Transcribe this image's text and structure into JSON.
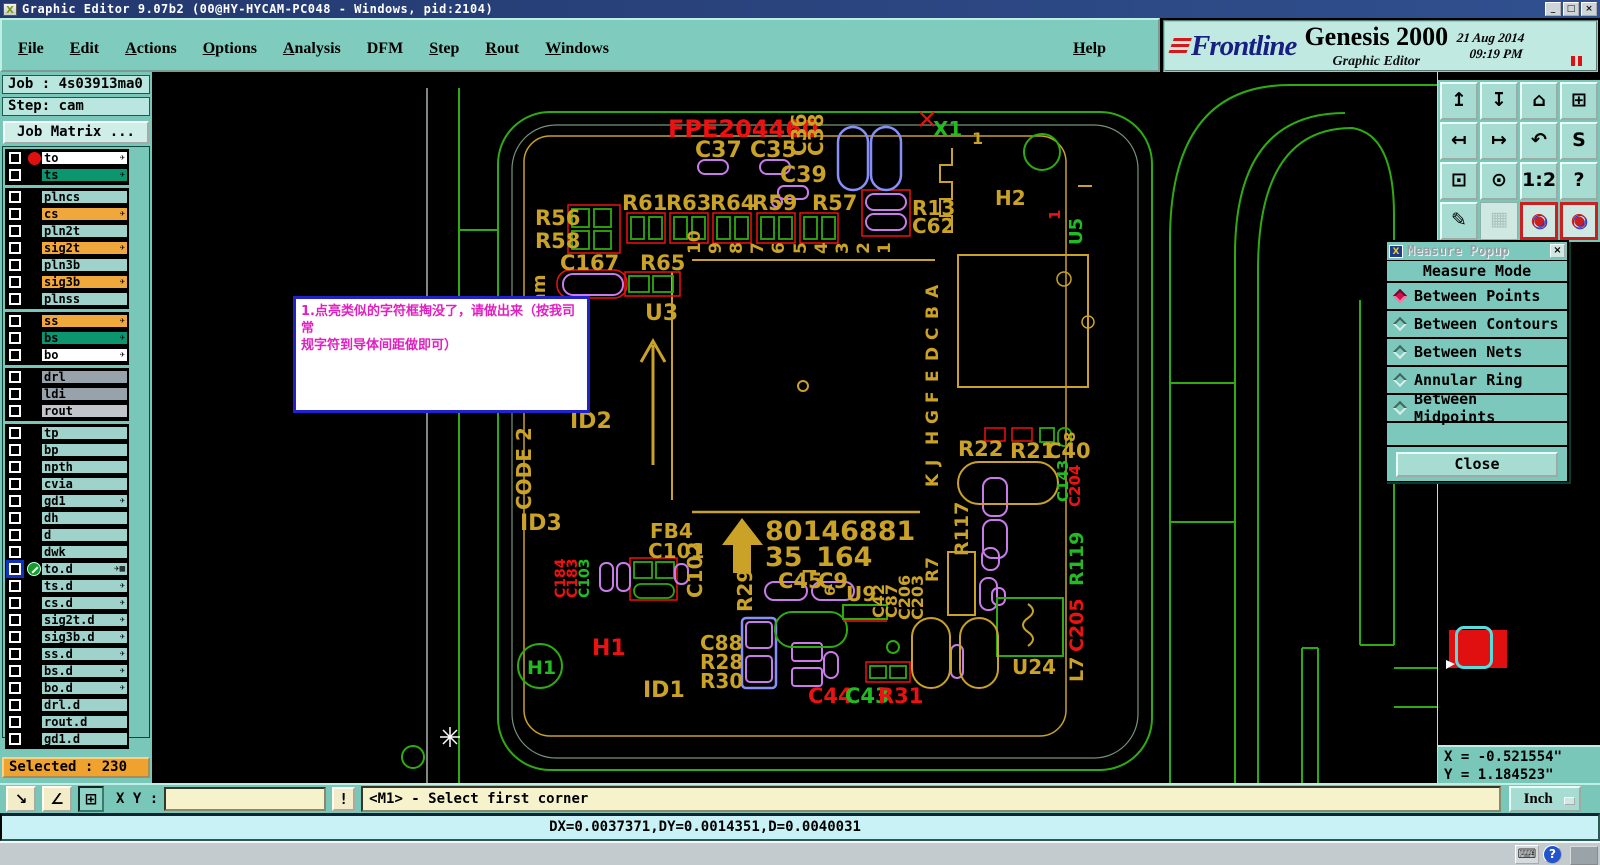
{
  "titlebar": {
    "title": "Graphic Editor 9.07b2 (00@HY-HYCAM-PC048 - Windows, pid:2104)",
    "window_buttons": [
      "_",
      "□",
      "×"
    ]
  },
  "menubar": {
    "items": [
      {
        "label": "File",
        "u": true
      },
      {
        "label": "Edit",
        "u": true
      },
      {
        "label": "Actions",
        "u": true
      },
      {
        "label": "Options",
        "u": true
      },
      {
        "label": "Analysis",
        "u": true
      },
      {
        "label": "DFM",
        "u": false
      },
      {
        "label": "Step",
        "u": true
      },
      {
        "label": "Rout",
        "u": true
      },
      {
        "label": "Windows",
        "u": true
      }
    ],
    "help": {
      "label": "Help",
      "u": true
    }
  },
  "brand": {
    "logo": "Frontline",
    "product": "Genesis 2000",
    "edition": "Graphic Editor",
    "date": "21 Aug 2014",
    "time": "09:19 PM"
  },
  "sidebar": {
    "job": "Job : 4s03913ma0",
    "step": "Step: cam",
    "job_matrix": "Job Matrix ...",
    "selected": "Selected : 230",
    "layer_groups": [
      [
        {
          "name": "to",
          "bg": "white",
          "arrow": true,
          "dot": true
        },
        {
          "name": "ts",
          "bg": "green",
          "arrow": true
        }
      ],
      [
        {
          "name": "plncs",
          "bg": "teal"
        },
        {
          "name": "cs",
          "bg": "orange",
          "arrow": true
        },
        {
          "name": "pln2t",
          "bg": "teal"
        },
        {
          "name": "sig2t",
          "bg": "orange",
          "arrow": true
        },
        {
          "name": "pln3b",
          "bg": "teal"
        },
        {
          "name": "sig3b",
          "bg": "orange",
          "arrow": true
        },
        {
          "name": "plnss",
          "bg": "teal"
        }
      ],
      [
        {
          "name": "ss",
          "bg": "orange",
          "arrow": true
        },
        {
          "name": "bs",
          "bg": "green",
          "arrow": true
        },
        {
          "name": "bo",
          "bg": "white",
          "arrow": true
        }
      ],
      [
        {
          "name": "drl",
          "bg": "gray"
        },
        {
          "name": "ldi",
          "bg": "gray"
        },
        {
          "name": "rout",
          "bg": "lightgray"
        }
      ],
      [
        {
          "name": "tp",
          "bg": "teal"
        },
        {
          "name": "bp",
          "bg": "teal"
        },
        {
          "name": "npth",
          "bg": "teal"
        },
        {
          "name": "cvia",
          "bg": "teal"
        },
        {
          "name": "gd1",
          "bg": "teal",
          "arrow": true
        },
        {
          "name": "dh",
          "bg": "teal"
        },
        {
          "name": "d",
          "bg": "teal"
        },
        {
          "name": "dwk",
          "bg": "teal"
        },
        {
          "name": "to.d",
          "bg": "teal",
          "arrow": true,
          "selected": true,
          "extra": "▦"
        },
        {
          "name": "ts.d",
          "bg": "teal",
          "arrow": true
        },
        {
          "name": "cs.d",
          "bg": "teal",
          "arrow": true
        },
        {
          "name": "sig2t.d",
          "bg": "teal",
          "arrow": true
        },
        {
          "name": "sig3b.d",
          "bg": "teal",
          "arrow": true
        },
        {
          "name": "ss.d",
          "bg": "teal",
          "arrow": true
        },
        {
          "name": "bs.d",
          "bg": "teal",
          "arrow": true
        },
        {
          "name": "bo.d",
          "bg": "teal",
          "arrow": true
        },
        {
          "name": "drl.d",
          "bg": "teal"
        },
        {
          "name": "rout.d",
          "bg": "teal"
        },
        {
          "name": "gd1.d",
          "bg": "teal"
        }
      ]
    ]
  },
  "canvas": {
    "silk": "#c9a227",
    "note": {
      "line1": "1.点亮类似的字符框掏没了，请做出来（按我司常",
      "line2": "规字符到导体间距做即可）"
    },
    "labels": [
      {
        "t": "FPE204460",
        "x": 668,
        "y": 137,
        "s": 24,
        "c": "#ee1111"
      },
      {
        "t": "C37",
        "x": 695,
        "y": 157,
        "s": 22
      },
      {
        "t": "C35",
        "x": 750,
        "y": 157,
        "s": 22
      },
      {
        "t": "C36",
        "x": 806,
        "y": 156,
        "s": 20,
        "r": -90
      },
      {
        "t": "C38",
        "x": 823,
        "y": 156,
        "s": 20,
        "r": -90
      },
      {
        "t": "C39",
        "x": 780,
        "y": 182,
        "s": 22
      },
      {
        "t": "R61",
        "x": 622,
        "y": 210,
        "s": 21
      },
      {
        "t": "R63",
        "x": 666,
        "y": 210,
        "s": 21
      },
      {
        "t": "R64",
        "x": 710,
        "y": 210,
        "s": 21
      },
      {
        "t": "R59",
        "x": 752,
        "y": 210,
        "s": 21
      },
      {
        "t": "R57",
        "x": 812,
        "y": 210,
        "s": 21
      },
      {
        "t": "R13",
        "x": 912,
        "y": 215,
        "s": 20
      },
      {
        "t": "C62",
        "x": 912,
        "y": 233,
        "s": 20
      },
      {
        "t": "X1",
        "x": 933,
        "y": 136,
        "s": 20,
        "c": "#22bb22"
      },
      {
        "t": "1",
        "x": 972,
        "y": 144,
        "s": 16
      },
      {
        "t": "H2",
        "x": 995,
        "y": 205,
        "s": 20
      },
      {
        "t": "1",
        "x": 1060,
        "y": 220,
        "s": 15,
        "c": "#ee1111",
        "r": -90
      },
      {
        "t": "U5",
        "x": 1082,
        "y": 245,
        "s": 18,
        "c": "#22bb22",
        "r": -90
      },
      {
        "t": "R56",
        "x": 535,
        "y": 225,
        "s": 21
      },
      {
        "t": "R58",
        "x": 535,
        "y": 248,
        "s": 21
      },
      {
        "t": "C167",
        "x": 560,
        "y": 270,
        "s": 21
      },
      {
        "t": "R65",
        "x": 640,
        "y": 270,
        "s": 21
      },
      {
        "t": "mm",
        "x": 545,
        "y": 312,
        "s": 18,
        "r": -90
      },
      {
        "t": "U3",
        "x": 645,
        "y": 320,
        "s": 22
      },
      {
        "t": "ID2",
        "x": 570,
        "y": 428,
        "s": 22
      },
      {
        "t": "CODE 2",
        "x": 531,
        "y": 510,
        "s": 20,
        "r": -90
      },
      {
        "t": "ID3",
        "x": 520,
        "y": 530,
        "s": 22
      },
      {
        "t": "FB4",
        "x": 650,
        "y": 538,
        "s": 20
      },
      {
        "t": "C101",
        "x": 648,
        "y": 558,
        "s": 20
      },
      {
        "t": "C102",
        "x": 702,
        "y": 598,
        "s": 20,
        "r": -90
      },
      {
        "t": "C184",
        "x": 565,
        "y": 598,
        "s": 14,
        "c": "#ee1111",
        "r": -90
      },
      {
        "t": "C183",
        "x": 577,
        "y": 598,
        "s": 14,
        "c": "#ee1111",
        "r": -90
      },
      {
        "t": "C103",
        "x": 589,
        "y": 598,
        "s": 14,
        "c": "#22bb22",
        "r": -90
      },
      {
        "t": "80146881",
        "x": 765,
        "y": 540,
        "s": 27
      },
      {
        "t": "35_164",
        "x": 765,
        "y": 566,
        "s": 27
      },
      {
        "t": "R29",
        "x": 752,
        "y": 612,
        "s": 20,
        "r": -90
      },
      {
        "t": "C45",
        "x": 778,
        "y": 588,
        "s": 21
      },
      {
        "t": "C9",
        "x": 818,
        "y": 588,
        "s": 21
      },
      {
        "t": "U9",
        "x": 846,
        "y": 601,
        "s": 20
      },
      {
        "t": "6",
        "x": 835,
        "y": 596,
        "s": 14,
        "r": -90
      },
      {
        "t": "C42",
        "x": 884,
        "y": 618,
        "s": 16,
        "r": -90
      },
      {
        "t": "C87",
        "x": 897,
        "y": 618,
        "s": 16,
        "r": -90
      },
      {
        "t": "C206",
        "x": 910,
        "y": 620,
        "s": 16,
        "r": -90
      },
      {
        "t": "C203",
        "x": 923,
        "y": 620,
        "s": 16,
        "r": -90
      },
      {
        "t": "R7",
        "x": 938,
        "y": 582,
        "s": 17,
        "r": -90
      },
      {
        "t": "R117",
        "x": 968,
        "y": 556,
        "s": 19,
        "r": -90
      },
      {
        "t": "C88",
        "x": 700,
        "y": 650,
        "s": 20
      },
      {
        "t": "R28",
        "x": 700,
        "y": 669,
        "s": 20
      },
      {
        "t": "R30",
        "x": 700,
        "y": 688,
        "s": 20
      },
      {
        "t": "C44",
        "x": 808,
        "y": 703,
        "s": 21,
        "c": "#ee1111"
      },
      {
        "t": "C43",
        "x": 845,
        "y": 703,
        "s": 21,
        "c": "#22bb22"
      },
      {
        "t": "R31",
        "x": 878,
        "y": 703,
        "s": 21,
        "c": "#ee1111"
      },
      {
        "t": "H1",
        "x": 592,
        "y": 655,
        "s": 22,
        "c": "#ee1111"
      },
      {
        "t": "H1",
        "x": 527,
        "y": 674,
        "s": 19,
        "c": "#22bb22"
      },
      {
        "t": "ID1",
        "x": 643,
        "y": 697,
        "s": 22
      },
      {
        "t": "R22",
        "x": 958,
        "y": 456,
        "s": 21
      },
      {
        "t": "R21",
        "x": 1010,
        "y": 458,
        "s": 21
      },
      {
        "t": "C40",
        "x": 1046,
        "y": 458,
        "s": 21
      },
      {
        "t": "8",
        "x": 1075,
        "y": 442,
        "s": 15,
        "r": -90
      },
      {
        "t": "C143",
        "x": 1068,
        "y": 502,
        "s": 15,
        "c": "#22bb22",
        "r": -90
      },
      {
        "t": "C204",
        "x": 1080,
        "y": 507,
        "s": 15,
        "c": "#ee1111",
        "r": -90
      },
      {
        "t": "U24",
        "x": 1012,
        "y": 674,
        "s": 20
      },
      {
        "t": "L7",
        "x": 1083,
        "y": 682,
        "s": 19,
        "r": -90
      },
      {
        "t": "C205",
        "x": 1083,
        "y": 652,
        "s": 19,
        "c": "#ee1111",
        "r": -90
      },
      {
        "t": "R119",
        "x": 1083,
        "y": 586,
        "s": 19,
        "c": "#22bb22",
        "r": -90
      },
      {
        "t": "10",
        "x": 700,
        "y": 254,
        "s": 17,
        "r": -90
      },
      {
        "t": "9",
        "x": 721,
        "y": 254,
        "s": 17,
        "r": -90
      },
      {
        "t": "8",
        "x": 742,
        "y": 254,
        "s": 17,
        "r": -90
      },
      {
        "t": "7",
        "x": 763,
        "y": 254,
        "s": 17,
        "r": -90
      },
      {
        "t": "6",
        "x": 784,
        "y": 254,
        "s": 17,
        "r": -90
      },
      {
        "t": "5",
        "x": 806,
        "y": 254,
        "s": 17,
        "r": -90
      },
      {
        "t": "4",
        "x": 827,
        "y": 254,
        "s": 17,
        "r": -90
      },
      {
        "t": "3",
        "x": 848,
        "y": 254,
        "s": 17,
        "r": -90
      },
      {
        "t": "2",
        "x": 869,
        "y": 254,
        "s": 17,
        "r": -90
      },
      {
        "t": "1",
        "x": 890,
        "y": 254,
        "s": 17,
        "r": -90
      },
      {
        "t": "A",
        "x": 938,
        "y": 298,
        "s": 17,
        "r": -90
      },
      {
        "t": "B",
        "x": 938,
        "y": 319,
        "s": 17,
        "r": -90
      },
      {
        "t": "C",
        "x": 938,
        "y": 340,
        "s": 17,
        "r": -90
      },
      {
        "t": "D",
        "x": 938,
        "y": 361,
        "s": 17,
        "r": -90
      },
      {
        "t": "E",
        "x": 938,
        "y": 382,
        "s": 17,
        "r": -90
      },
      {
        "t": "F",
        "x": 938,
        "y": 403,
        "s": 17,
        "r": -90
      },
      {
        "t": "G",
        "x": 938,
        "y": 424,
        "s": 17,
        "r": -90
      },
      {
        "t": "H",
        "x": 938,
        "y": 445,
        "s": 17,
        "r": -90
      },
      {
        "t": "J",
        "x": 938,
        "y": 466,
        "s": 17,
        "r": -90
      },
      {
        "t": "K",
        "x": 938,
        "y": 487,
        "s": 17,
        "r": -90
      }
    ]
  },
  "measure_popup": {
    "title": "Measure Popup",
    "header": "Measure Mode",
    "options": [
      {
        "label": "Between Points",
        "selected": true
      },
      {
        "label": "Between Contours",
        "selected": false
      },
      {
        "label": "Between Nets",
        "selected": false
      },
      {
        "label": "Annular Ring",
        "selected": false
      },
      {
        "label": "Between Midpoints",
        "selected": false
      }
    ],
    "close": "Close"
  },
  "toolbar_right": {
    "buttons": [
      {
        "name": "zoom-in",
        "glyph": "↥"
      },
      {
        "name": "zoom-out",
        "glyph": "↧"
      },
      {
        "name": "home-view",
        "glyph": "⌂"
      },
      {
        "name": "window-xy",
        "glyph": "⊞"
      },
      {
        "name": "pan-left",
        "glyph": "↤"
      },
      {
        "name": "pan-right",
        "glyph": "↦"
      },
      {
        "name": "undo-view",
        "glyph": "↶"
      },
      {
        "name": "step-outline",
        "glyph": "S"
      },
      {
        "name": "zoom-fit",
        "glyph": "⊡"
      },
      {
        "name": "zoom-center",
        "glyph": "⊙"
      },
      {
        "name": "scale-1-2",
        "glyph": "1:2"
      },
      {
        "name": "help-pick",
        "glyph": "?"
      },
      {
        "name": "edit-tools",
        "glyph": "✎"
      },
      {
        "name": "grid-toggle",
        "glyph": "▦",
        "flat": true
      },
      {
        "name": "netlist-a",
        "glyph": "◉",
        "active": true
      },
      {
        "name": "netlist-b",
        "glyph": "◉",
        "active": true
      }
    ]
  },
  "commandbar": {
    "icons": [
      {
        "name": "select-mode",
        "glyph": "↘"
      },
      {
        "name": "measure-angle",
        "glyph": "∠"
      },
      {
        "name": "grid-snap",
        "glyph": "⊞",
        "pressed": true
      }
    ],
    "xy_label": "X Y :",
    "input_value": "",
    "exclaim": "!",
    "message": "<M1> - Select first corner",
    "units": "Inch"
  },
  "statusbar": {
    "delta": "DX=0.0037371,DY=0.0014351,D=0.0040031"
  },
  "coords": {
    "x": "X = -0.521554\"",
    "y": "Y = 1.184523\""
  },
  "taskbar": {
    "icons": [
      {
        "name": "keyboard-icon",
        "glyph": "⌨"
      },
      {
        "name": "help-icon",
        "glyph": "?",
        "q": true
      }
    ]
  }
}
